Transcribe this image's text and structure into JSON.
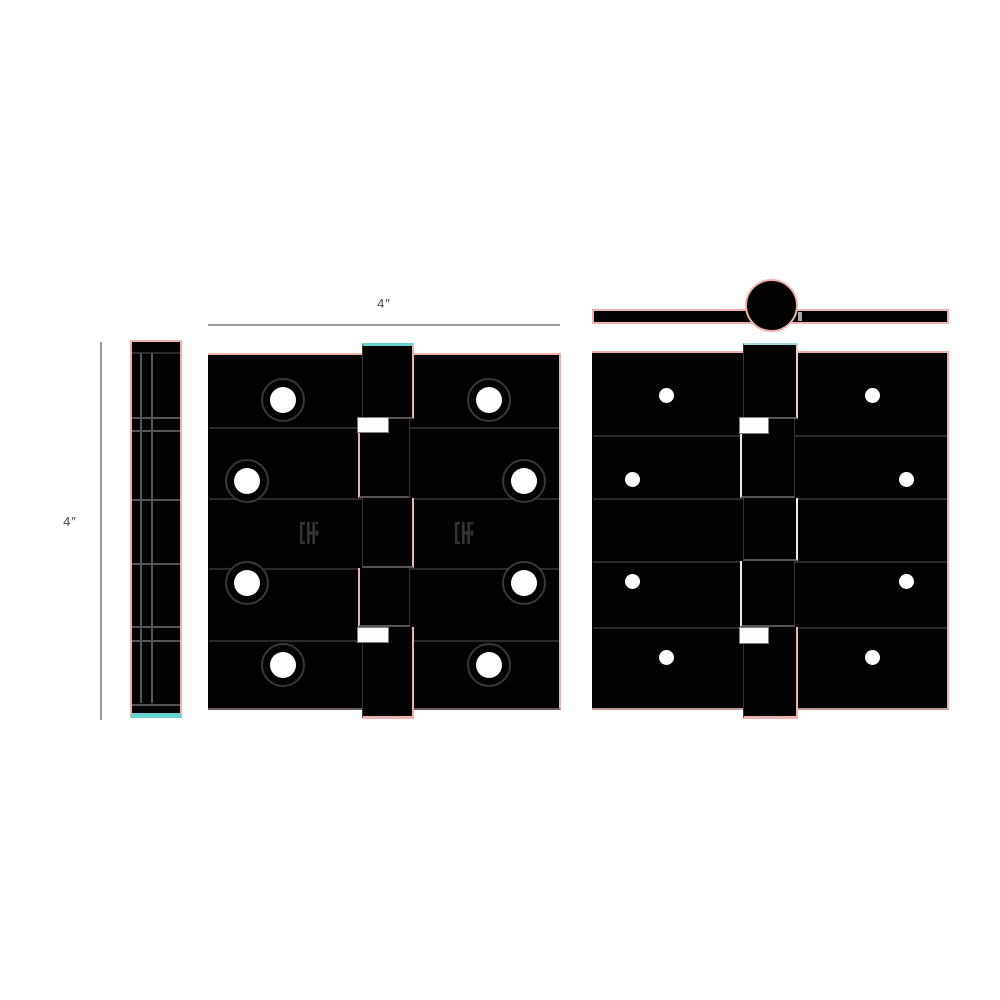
{
  "dimensions": {
    "width": {
      "label": "4″"
    },
    "height": {
      "label": "4″"
    }
  },
  "views": {
    "edge": {
      "description": "hinge edge (closed side) view"
    },
    "front": {
      "description": "hinge front view",
      "screw_hole_count": 8,
      "knuckle_segment_count": 5,
      "logo_mark_count": 2
    },
    "top": {
      "description": "hinge top view with pin head"
    },
    "rear": {
      "description": "hinge rear view",
      "screw_hole_count": 8,
      "knuckle_segment_count": 5
    }
  },
  "colors": {
    "bg": "#ffffff",
    "black": "#020202",
    "pink": "#efb1ac",
    "pinklight": "#f2cdc9",
    "cyan": "#66d2cd",
    "dimline": "#9a9a9a",
    "dimtext": "#4a4a4a",
    "joint": "#2b2b2b",
    "logo": "#343434"
  }
}
